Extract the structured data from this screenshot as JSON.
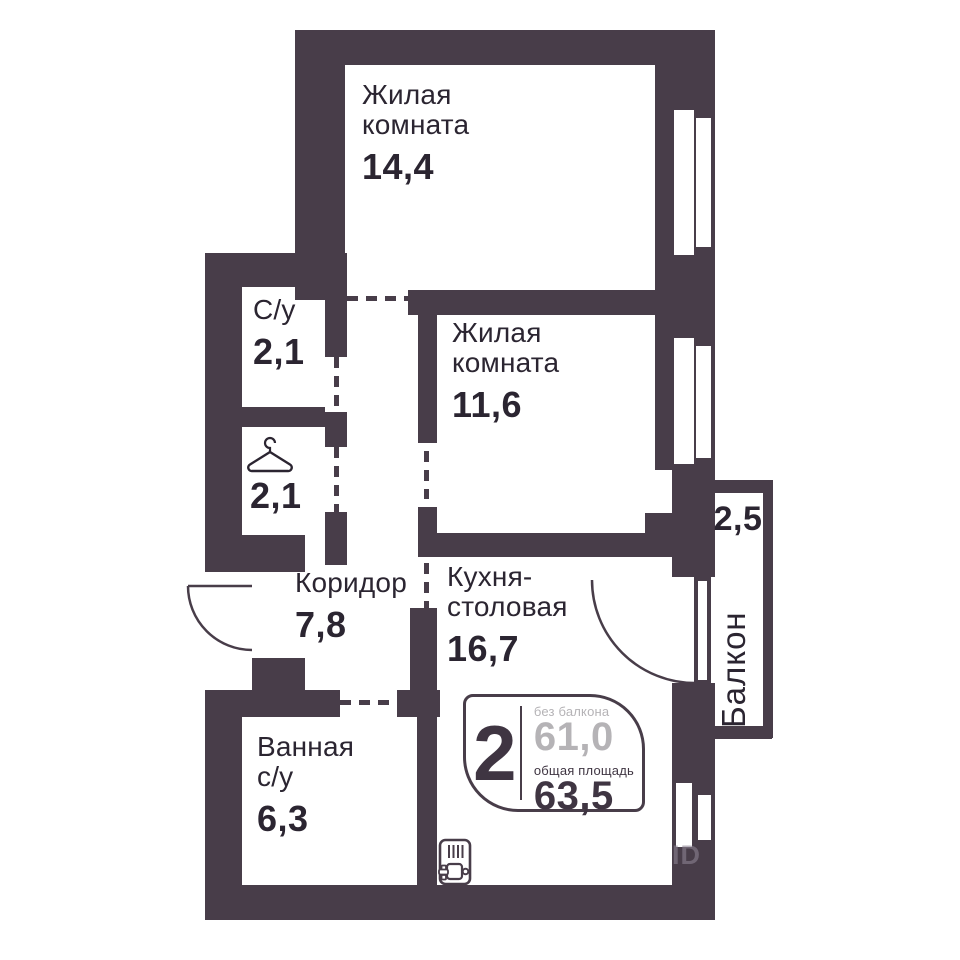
{
  "colors": {
    "wall": "#483d49",
    "text": "#2b2531",
    "muted_value": "#b5b3b6"
  },
  "rooms": {
    "living_room_1": {
      "label": "Жилая комната",
      "area": "14,4"
    },
    "living_room_2": {
      "label": "Жилая комната",
      "area": "11,6"
    },
    "wc_small": {
      "label": "С/у",
      "area": "2,1"
    },
    "wardrobe": {
      "area": "2,1",
      "icon": "hanger-icon"
    },
    "corridor": {
      "label": "Коридор",
      "area": "7,8"
    },
    "kitchen_dining": {
      "label": "Кухня-столовая",
      "area": "16,7"
    },
    "bathroom": {
      "label": "Ванная с/у",
      "area": "6,3"
    },
    "balcony": {
      "label": "Балкон",
      "area": "2,5"
    }
  },
  "info_badge": {
    "rooms_count": "2",
    "without_balcony_label": "без балкона",
    "without_balcony_value": "61,0",
    "total_area_label": "общая площадь",
    "total_area_value": "63,5"
  },
  "watermark": "ID",
  "icons": {
    "wardrobe": "hanger-icon",
    "kitchen": "stove-sink-icon"
  }
}
